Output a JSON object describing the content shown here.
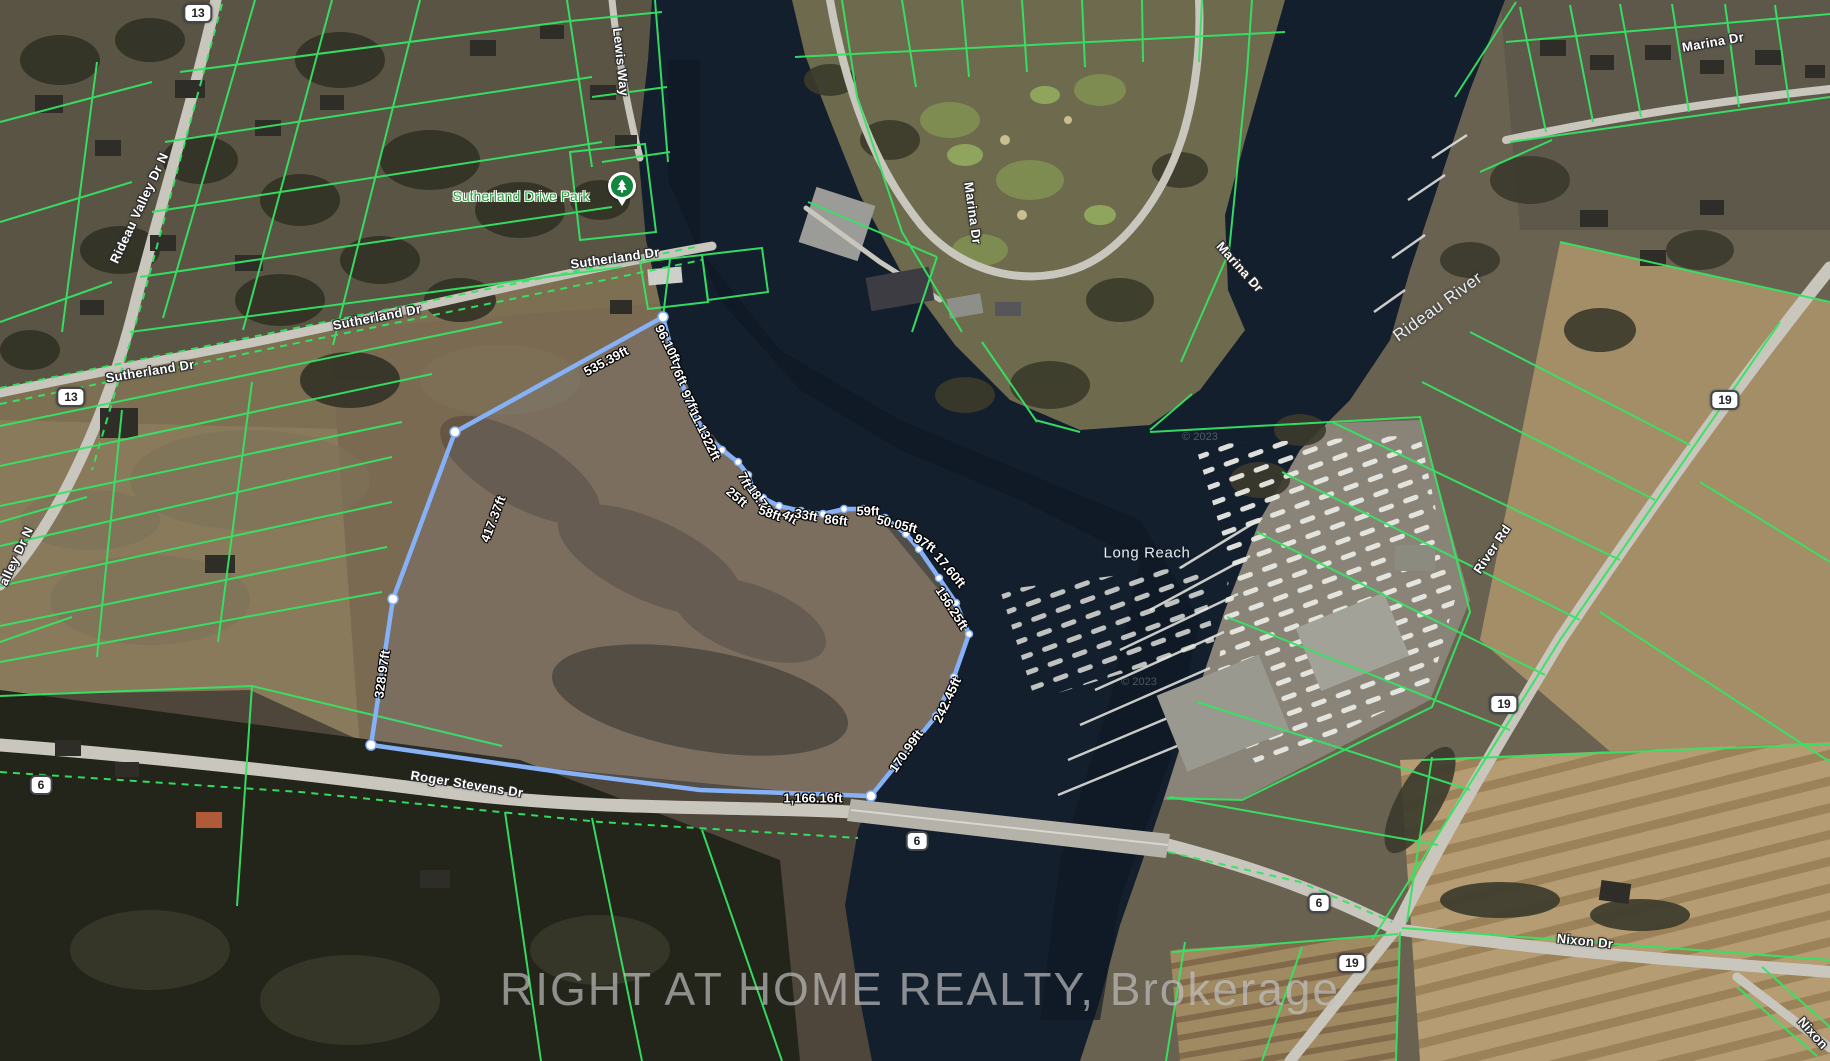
{
  "map": {
    "watermark": "RIGHT AT HOME REALTY, Brokerage",
    "attribution": "© 2023",
    "park": {
      "label": "Sutherland Drive Park"
    },
    "colors": {
      "parcel_line_green": "#35e463",
      "property_boundary_blue": "#86b1f7",
      "water": "#141f2d",
      "road_gray": "#c9c6bd",
      "park_label_green": "#2f9e41"
    },
    "road_labels": [
      {
        "text": "Lewis Way",
        "x": 621,
        "y": 62,
        "rot": 84
      },
      {
        "text": "Sutherland Dr",
        "x": 615,
        "y": 258,
        "rot": -8
      },
      {
        "text": "Sutherland Dr",
        "x": 377,
        "y": 317,
        "rot": -11
      },
      {
        "text": "Sutherland Dr",
        "x": 150,
        "y": 371,
        "rot": -9
      },
      {
        "text": "Rideau Valley Dr N",
        "x": 139,
        "y": 208,
        "rot": -65
      },
      {
        "text": "alley Dr N",
        "x": 16,
        "y": 556,
        "rot": -65
      },
      {
        "text": "Marina Dr",
        "x": 973,
        "y": 213,
        "rot": 82
      },
      {
        "text": "Marina Dr",
        "x": 1240,
        "y": 267,
        "rot": 48
      },
      {
        "text": "Marina Dr",
        "x": 1713,
        "y": 42,
        "rot": -10
      },
      {
        "text": "River Rd",
        "x": 1492,
        "y": 549,
        "rot": -56
      },
      {
        "text": "Roger Stevens Dr",
        "x": 467,
        "y": 784,
        "rot": 9
      },
      {
        "text": "Nixon Dr",
        "x": 1585,
        "y": 941,
        "rot": 6
      },
      {
        "text": "Nixon",
        "x": 1813,
        "y": 1033,
        "rot": 48
      }
    ],
    "water_labels": [
      {
        "text": "Rideau River",
        "x": 1438,
        "y": 307,
        "rot": -36,
        "size": 17
      },
      {
        "text": "Long Reach",
        "x": 1147,
        "y": 553,
        "rot": 0,
        "size": 15
      }
    ],
    "route_shields": [
      {
        "num": "13",
        "x": 198,
        "y": 13
      },
      {
        "num": "13",
        "x": 71,
        "y": 397
      },
      {
        "num": "6",
        "x": 41,
        "y": 785
      },
      {
        "num": "6",
        "x": 917,
        "y": 841
      },
      {
        "num": "6",
        "x": 1319,
        "y": 903
      },
      {
        "num": "19",
        "x": 1725,
        "y": 400
      },
      {
        "num": "19",
        "x": 1504,
        "y": 704
      },
      {
        "num": "19",
        "x": 1352,
        "y": 963
      }
    ],
    "property_boundary": {
      "measurements": [
        {
          "text": "535.39ft",
          "x": 606,
          "y": 361,
          "rot": -28
        },
        {
          "text": "96.10ft",
          "x": 668,
          "y": 344,
          "rot": 63
        },
        {
          "text": "76ft",
          "x": 679,
          "y": 374,
          "rot": 63
        },
        {
          "text": "97ft",
          "x": 690,
          "y": 401,
          "rot": 63
        },
        {
          "text": "11.13ft",
          "x": 702,
          "y": 428,
          "rot": 63
        },
        {
          "text": "22ft",
          "x": 712,
          "y": 449,
          "rot": 63
        },
        {
          "text": "7ft",
          "x": 745,
          "y": 480,
          "rot": 63
        },
        {
          "text": "25ft",
          "x": 737,
          "y": 497,
          "rot": 40
        },
        {
          "text": "18.7ft",
          "x": 760,
          "y": 500,
          "rot": 55
        },
        {
          "text": "58ft",
          "x": 770,
          "y": 513,
          "rot": 20
        },
        {
          "text": "4ft",
          "x": 790,
          "y": 517,
          "rot": 30
        },
        {
          "text": "33ft",
          "x": 806,
          "y": 515,
          "rot": 10
        },
        {
          "text": "86ft",
          "x": 836,
          "y": 520,
          "rot": 6
        },
        {
          "text": "59ft",
          "x": 868,
          "y": 511,
          "rot": 0
        },
        {
          "text": "50.05ft",
          "x": 897,
          "y": 524,
          "rot": 14
        },
        {
          "text": "97ft",
          "x": 925,
          "y": 543,
          "rot": 33
        },
        {
          "text": "17.60ft",
          "x": 950,
          "y": 570,
          "rot": 50
        },
        {
          "text": "156.25ft",
          "x": 952,
          "y": 608,
          "rot": 57
        },
        {
          "text": "242.45ft",
          "x": 947,
          "y": 700,
          "rot": -65
        },
        {
          "text": "170.99ft",
          "x": 906,
          "y": 751,
          "rot": -55
        },
        {
          "text": "1,166.16ft",
          "x": 813,
          "y": 798,
          "rot": 0
        },
        {
          "text": "328.97ft",
          "x": 382,
          "y": 674,
          "rot": -82
        },
        {
          "text": "417.37ft",
          "x": 493,
          "y": 519,
          "rot": -69
        }
      ]
    }
  }
}
